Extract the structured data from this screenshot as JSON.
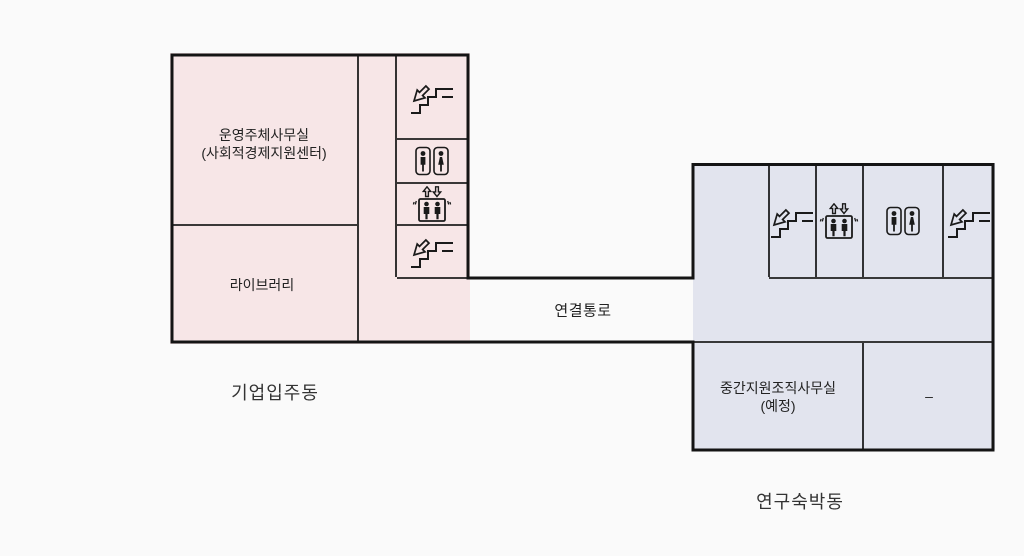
{
  "colors": {
    "background": "#fafafa",
    "left_building_fill": "#f7e6e7",
    "right_building_fill": "#e2e4ee",
    "wall": "#141414",
    "inner_line": "#1f1f1f",
    "icon": "#1a1a1a",
    "room_text": "#222222",
    "building_label_text": "#333333"
  },
  "buildings": {
    "left": {
      "name": "기업입주동",
      "rooms": {
        "office": {
          "line1": "운영주체사무실",
          "line2": "(사회적경제지원센터)"
        },
        "library": {
          "label": "라이브러리"
        }
      },
      "facilities": [
        "stairs-down",
        "restroom",
        "elevator",
        "stairs-down"
      ]
    },
    "right": {
      "name": "연구숙박동",
      "rooms": {
        "support_office": {
          "line1": "중간지원조직사무실",
          "line2": "(예정)"
        },
        "unassigned": {
          "label": "–"
        }
      },
      "facilities": [
        "stairs-down",
        "elevator",
        "restroom",
        "stairs-down"
      ]
    }
  },
  "passage": {
    "label": "연결통로"
  }
}
